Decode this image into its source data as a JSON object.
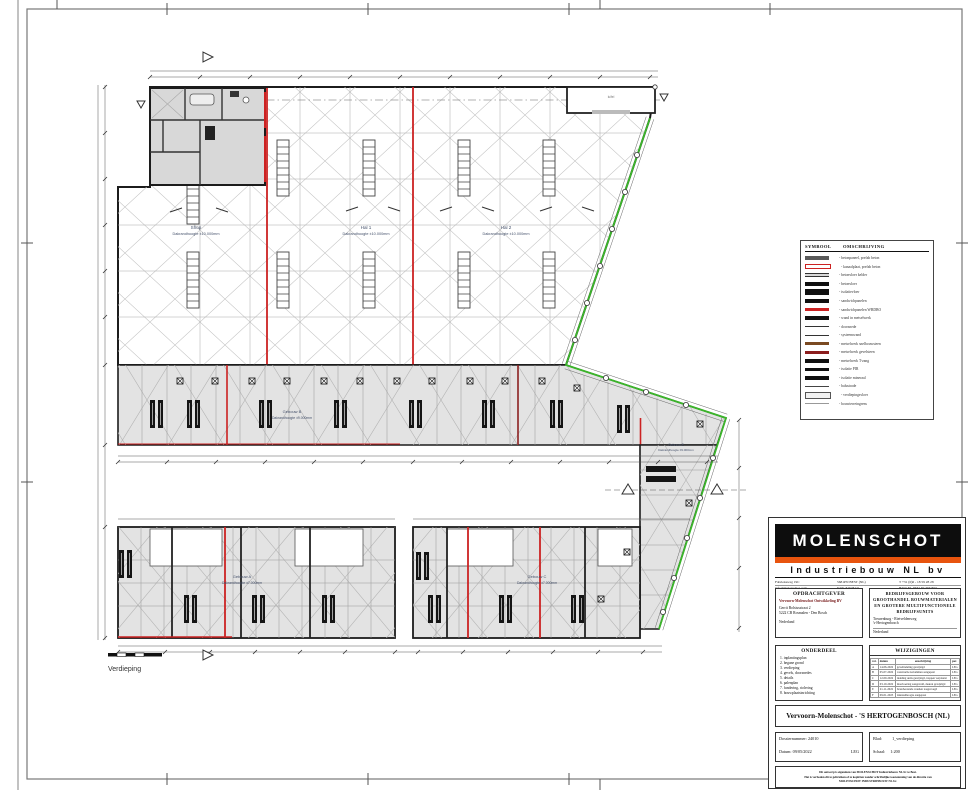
{
  "plan": {
    "labels": {
      "shop": {
        "name": "Shop",
        "height": "Dakrandhoogte ±10.000mm"
      },
      "hal1": {
        "name": "Hal 1",
        "height": "Dakrandhoogte ±10.000mm"
      },
      "hal2": {
        "name": "Hal 2",
        "height": "Dakrandhoogte ±10.000mm"
      },
      "gebouw_b": {
        "name": "Gebouw B",
        "height": "Dakrandhoogte ±9.000mm"
      },
      "gebouw_e": {
        "name": "Gebouw E",
        "height": "Dakrandhoogte ±9.000mm"
      },
      "gebouw_a": {
        "name": "Gebouw A",
        "height": "Dakrandhoogte ±7.000mm"
      },
      "gebouw_c": {
        "name": "Gebouw C",
        "height": "Dakrandhoogte ±7.000mm"
      },
      "canopy": "luifel",
      "floor": "Verdieping"
    },
    "legend": {
      "symbol_header": "SYMBOOL",
      "description_header": "OMSCHRIJVING",
      "items": [
        "- betonpaneel, prefab beton",
        "- kanaalplaat, prefab beton",
        "- betonvloer kelder",
        "- betonvloer",
        "- isolatievloer",
        "- sandwichpanelen",
        "- sandwichpanelen WBDBO",
        "- wand in metselwerk",
        "- doorsnede",
        "- systeemwand",
        "- metselwerk snelbouwsteen",
        "- metselwerk gevelsteen",
        "- metselwerk T-zang",
        "- isolatie PIR",
        "- isolatie mineraal",
        "- balustrade",
        "- verdiepingsvloer",
        "- bouwterreingrens"
      ]
    }
  },
  "titleblock": {
    "company": "MOLENSCHOT",
    "subtitle": "Industriebouw NL bv",
    "contact": {
      "address": "Fabrieksweg 19C",
      "city": "5681PN BEST (NL)",
      "phone": "T +31 (0)6 - 18 59 28 28",
      "email": "info@molenschot.com",
      "kvk": "KVK 84628421",
      "btw": "BTW NL 8632.87.366.B01"
    },
    "opdrachtgever": {
      "header": "OPDRACHTGEVER",
      "name": "Vervoorn-Molenschot Ontwikkeling BV",
      "address": "Gerrit Bolsiusstraat 2",
      "city": "5222 CB Rosmalen - Den Bosch",
      "country": "Nederland"
    },
    "project": {
      "header": "BEDRIJFSGEBOUW VOOR GROOTHANDEL BOUWMATERIALEN EN GROTERE MULTIFUNCTIONELE BEDRIJFSUNITS",
      "street": "Treurenburg - Rietveldenweg",
      "city": "'s-Hertogenbosch",
      "country": "Nederland"
    },
    "onderdeel": {
      "header": "ONDERDEEL",
      "items": [
        "1. inplantingsplan",
        "2. begane grond",
        "3. verdieping",
        "4. gevels, doorsnedes",
        "5. details",
        "6. palenplan",
        "7. fundering, riolering",
        "8. bouwplaatsinrichting"
      ]
    },
    "wijzigingen": {
      "header": "WIJZIGINGEN",
      "columns": [
        "ver.",
        "datum",
        "omschrijving",
        "par."
      ],
      "rows": [
        {
          "ver": "A",
          "datum": "14-06-2022",
          "omschrijving": "gevelindeling gewijzigd",
          "par": "LEG"
        },
        {
          "ver": "B",
          "datum": "05-07-2022",
          "omschrijving": "constructie kolommen aangepast",
          "par": "LEG"
        },
        {
          "ver": "C",
          "datum": "12-09-2022",
          "omschrijving": "indeling units gewijzigd, trappen verplaatst",
          "par": "LEG"
        },
        {
          "ver": "D",
          "datum": "03-10-2022",
          "omschrijving": "maatvoering aangevuld, deuren gewijzigd",
          "par": "LEG"
        },
        {
          "ver": "E",
          "datum": "21-11-2022",
          "omschrijving": "brandwerende wanden toegevoegd",
          "par": "LEG"
        },
        {
          "ver": "F",
          "datum": "09-01-2023",
          "omschrijving": "dakrandhoogte aangepast",
          "par": "LEG"
        }
      ]
    },
    "title": "Vervoorn-Molenschot - 'S HERTOGENBOSCH (NL)",
    "dossier": {
      "number": "Dossiernummer: 24010",
      "date": "Datum: 09/05/2022",
      "initials": "LEG"
    },
    "blad": {
      "sheet_label": "Blad:",
      "sheet": "1_verdieping",
      "schaal_label": "Schaal:",
      "schaal": "1:200"
    },
    "disclaimer": {
      "line1": "Dit ontwerp is eigendom van MOLENSCHOT Industriebouw NL bv te Best.",
      "line2": "Het is verboden dit te gebruiken of te kopiëren zonder schriftelijke toestemming van de directie van",
      "line3": "MOLENSCHOT INDUSTRIEBOUW NL bv."
    }
  },
  "colors": {
    "accent_orange": "#e8540e",
    "wall_red": "#cc2222",
    "boundary_green": "#3bb52a",
    "unit_gray": "#e3e3e3"
  }
}
